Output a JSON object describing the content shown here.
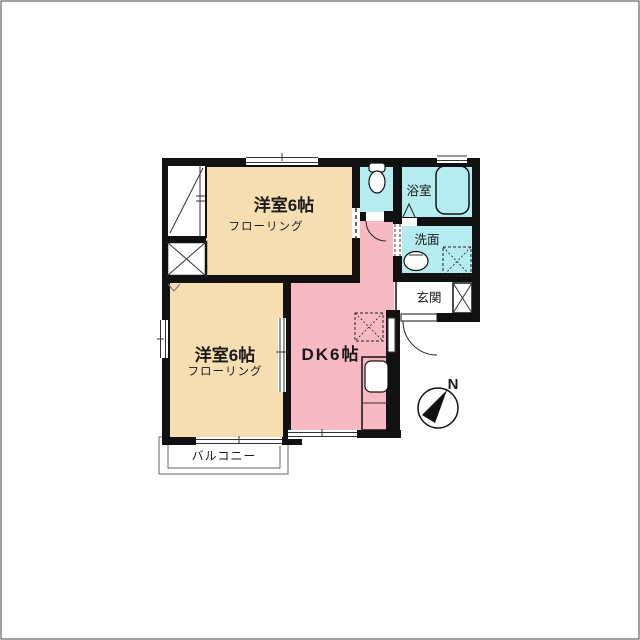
{
  "rooms": {
    "bedroom_top": {
      "label": "洋室6帖",
      "floor_note": "フローリング"
    },
    "bedroom_bottom": {
      "label": "洋室6帖",
      "floor_note": "フローリング"
    },
    "dining_kitchen": {
      "label": "DK6帖"
    },
    "bath": {
      "label": "浴室"
    },
    "washroom": {
      "label": "洗面"
    },
    "entrance": {
      "label": "玄関"
    },
    "balcony": {
      "label": "バルコニー"
    }
  },
  "compass": {
    "north_label": "N"
  },
  "colors": {
    "bedroom_fill": "#F7DEB2",
    "dk_fill": "#F8BAC2",
    "wet_area_fill": "#B4ECF0",
    "wall": "#111111",
    "sub_text": "#777777",
    "balcony_text": "#555555"
  },
  "icons": [
    "toilet-icon",
    "bathtub-icon",
    "washbasin-icon",
    "washing-machine-icon",
    "refrigerator-icon",
    "kitchen-sink-icon",
    "shoe-cabinet-icon",
    "closet-icon",
    "storage-icon",
    "compass-icon"
  ]
}
